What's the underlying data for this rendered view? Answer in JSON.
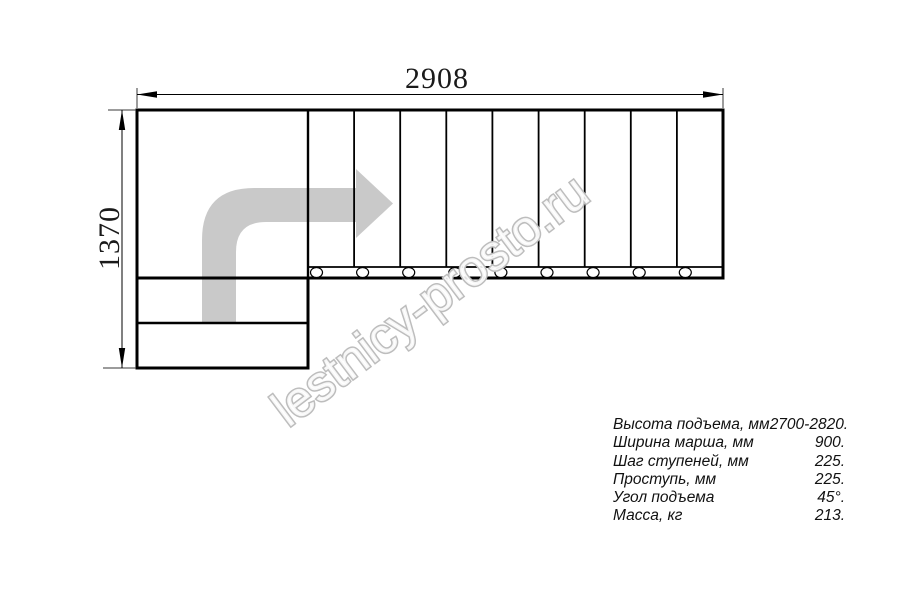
{
  "dimensions": {
    "width_label": "2908",
    "height_label": "1370"
  },
  "watermark": {
    "text": "lestnicy-prosto.ru"
  },
  "plan": {
    "upper_flight_treads": 9,
    "lower_flight_treads": 2,
    "direction": "up from bottom flight, turn right on landing"
  },
  "specs": {
    "rows": [
      {
        "label": "Высота подъема, мм",
        "value": "2700-2820."
      },
      {
        "label": "Ширина марша, мм",
        "value": "900."
      },
      {
        "label": "Шаг ступеней, мм",
        "value": "225."
      },
      {
        "label": "Проступь, мм",
        "value": "225."
      },
      {
        "label": "Угол подъема",
        "value": "45°."
      },
      {
        "label": "Масса, кг",
        "value": "213."
      }
    ]
  },
  "colors": {
    "line": "#000000",
    "arrow_fill": "#c9c9c9",
    "watermark_stroke": "#bdbdbd"
  }
}
